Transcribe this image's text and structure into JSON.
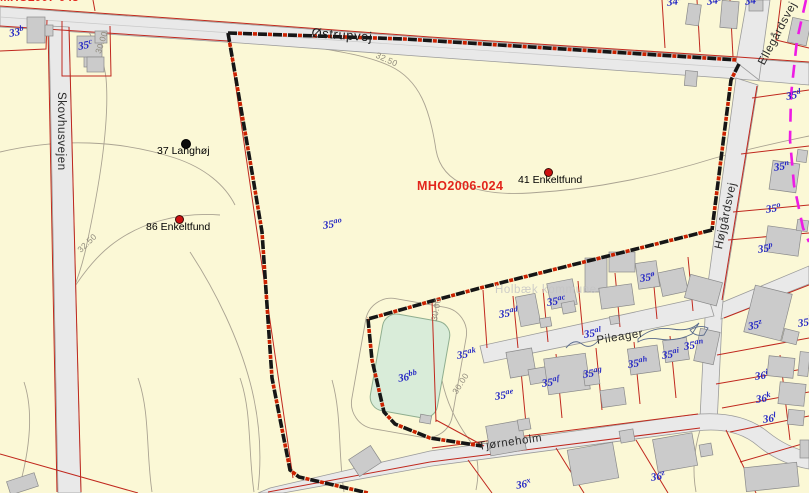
{
  "map": {
    "case_label": "MHO2006-024",
    "clipped_case_label": "MHO2007-043",
    "watermark": "Holbæk kommune",
    "roads": {
      "ostrupvej": "Østrupvej",
      "skovhusvejen": "Skovhusvejen",
      "ellegardsvej": "Ellegårdsvej",
      "hojgardsvej": "Højgårdsvej",
      "pileager": "Pileager",
      "tjorneholm": "Tjørneholm"
    },
    "finds": [
      {
        "label": "37 Langhøj",
        "dot": "black",
        "tx": 157,
        "ty": 146,
        "dx": 181,
        "dy": 139
      },
      {
        "label": "86 Enkeltfund",
        "dot": "red",
        "tx": 146,
        "ty": 222,
        "dx": 175,
        "dy": 215
      },
      {
        "label": "41 Enkeltfund",
        "dot": "red",
        "tx": 518,
        "ty": 175,
        "dx": 544,
        "dy": 168
      }
    ],
    "contour_labels": [
      {
        "text": "32.50",
        "x": 378,
        "y": 51,
        "r": 24
      },
      {
        "text": "30.00",
        "x": 94,
        "y": 52,
        "r": -72
      },
      {
        "text": "32.50",
        "x": 76,
        "y": 248,
        "r": -44
      },
      {
        "text": "30.00",
        "x": 430,
        "y": 320,
        "r": -80
      },
      {
        "text": "30.00",
        "x": 451,
        "y": 391,
        "r": -58
      }
    ],
    "parcels": [
      {
        "label": "33b",
        "x": 8,
        "y": 27,
        "r": -10
      },
      {
        "label": "35c",
        "x": 77,
        "y": 40,
        "r": -10
      },
      {
        "label": "34m",
        "x": 666,
        "y": -4,
        "r": -8
      },
      {
        "label": "34g",
        "x": 706,
        "y": -5,
        "r": -8
      },
      {
        "label": "34o",
        "x": 744,
        "y": -5,
        "r": -8
      },
      {
        "label": "35d",
        "x": 785,
        "y": 90,
        "r": -10
      },
      {
        "label": "35n",
        "x": 773,
        "y": 161,
        "r": -8
      },
      {
        "label": "35o",
        "x": 765,
        "y": 203,
        "r": -8
      },
      {
        "label": "35p",
        "x": 757,
        "y": 243,
        "r": -8
      },
      {
        "label": "35z",
        "x": 747,
        "y": 320,
        "r": -10
      },
      {
        "label": "35b",
        "x": 797,
        "y": 317,
        "r": -8
      },
      {
        "label": "36i",
        "x": 754,
        "y": 370,
        "r": -8
      },
      {
        "label": "36k",
        "x": 755,
        "y": 393,
        "r": -8
      },
      {
        "label": "36l",
        "x": 762,
        "y": 413,
        "r": -8
      },
      {
        "label": "35ø",
        "x": 639,
        "y": 272,
        "r": -8
      },
      {
        "label": "35ac",
        "x": 546,
        "y": 296,
        "r": -8
      },
      {
        "label": "35ad",
        "x": 498,
        "y": 308,
        "r": -8
      },
      {
        "label": "35al",
        "x": 583,
        "y": 328,
        "r": -8
      },
      {
        "label": "35ak",
        "x": 456,
        "y": 349,
        "r": -8
      },
      {
        "label": "35ae",
        "x": 494,
        "y": 390,
        "r": -8
      },
      {
        "label": "35af",
        "x": 541,
        "y": 377,
        "r": -8
      },
      {
        "label": "35ag",
        "x": 582,
        "y": 368,
        "r": -8
      },
      {
        "label": "35ah",
        "x": 627,
        "y": 358,
        "r": -8
      },
      {
        "label": "35ai",
        "x": 661,
        "y": 349,
        "r": -8
      },
      {
        "label": "35an",
        "x": 683,
        "y": 340,
        "r": -8
      },
      {
        "label": "36bb",
        "x": 397,
        "y": 372,
        "r": -10
      },
      {
        "label": "36x",
        "x": 515,
        "y": 479,
        "r": -10
      },
      {
        "label": "36z",
        "x": 650,
        "y": 471,
        "r": -8
      },
      {
        "label": "35ao",
        "x": 322,
        "y": 219,
        "r": -8
      }
    ],
    "colors": {
      "parcel_fill": "#fbf8d6",
      "road_fill": "#e9e9e9",
      "cadastral_red": "#c0281e",
      "label_blue": "#2629c4",
      "boundary_black": "#161616",
      "boundary_red": "#cc2200",
      "municipal_magenta": "#ee1be4",
      "pond_green": "#d9ecd9",
      "contour_gray": "#aaa392",
      "building_gray": "#cbcbcb",
      "case_red": "#e2251b"
    }
  }
}
